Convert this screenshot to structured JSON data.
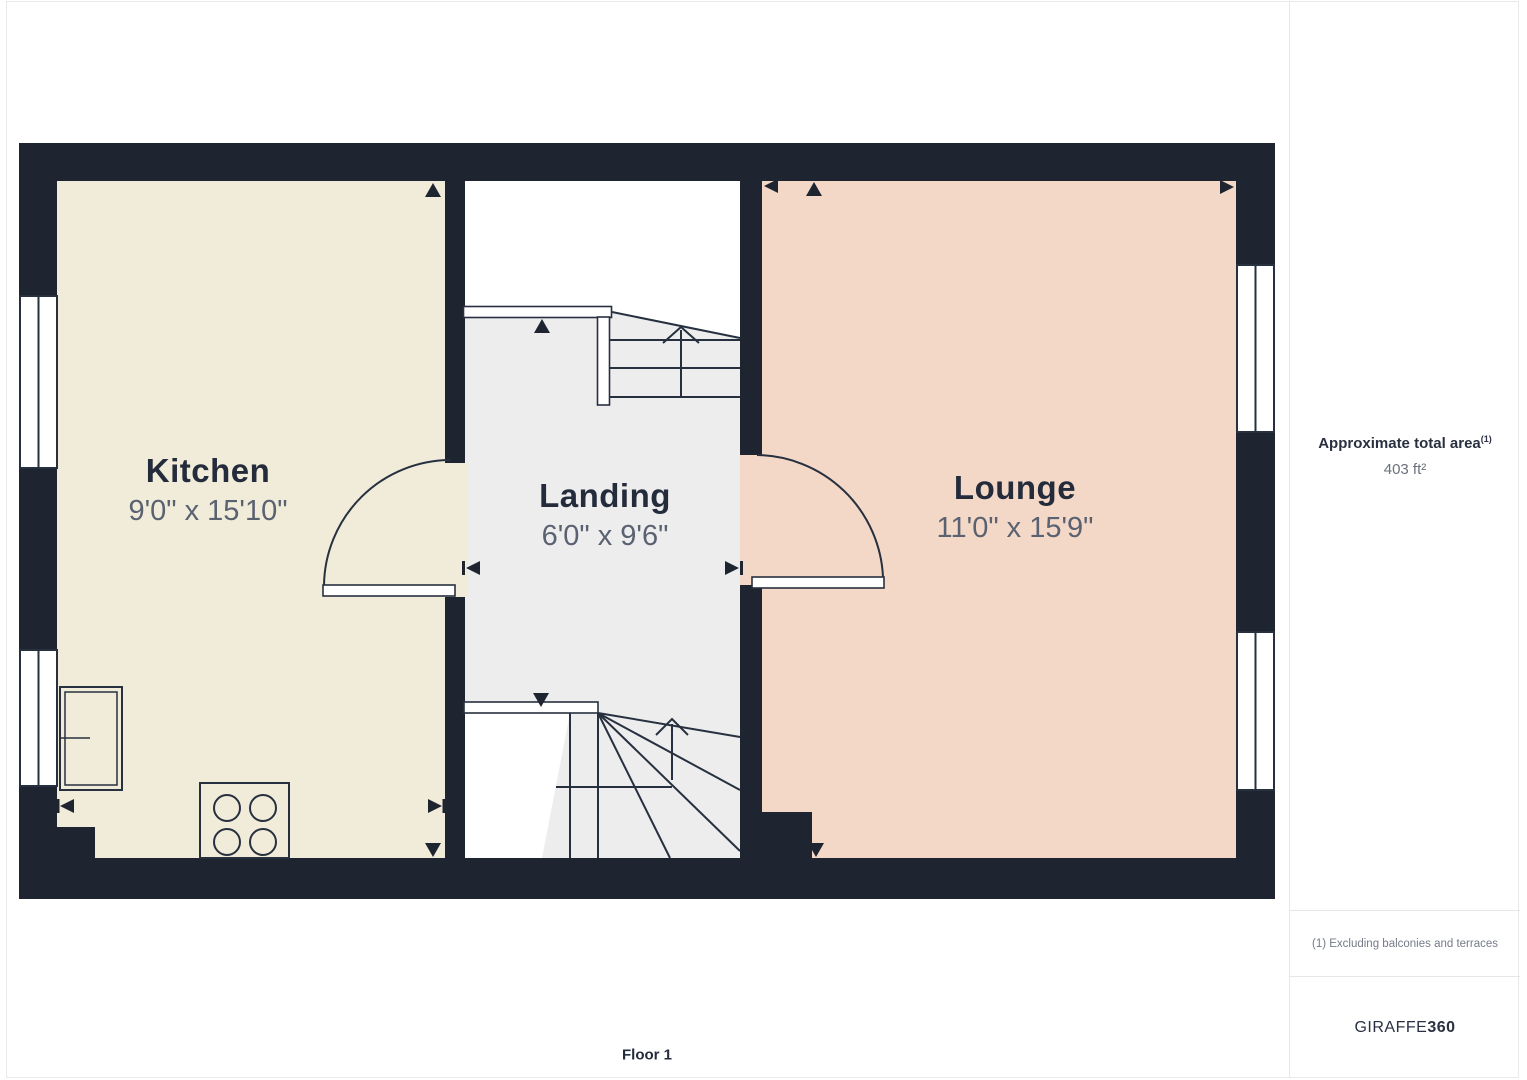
{
  "rooms": [
    {
      "name": "Kitchen",
      "dims": "9'0\" x 15'10\""
    },
    {
      "name": "Landing",
      "dims": "6'0\" x 9'6\""
    },
    {
      "name": "Lounge",
      "dims": "11'0\" x 15'9\""
    }
  ],
  "floor_label": "Floor 1",
  "sidebar": {
    "area_title": "Approximate total area",
    "area_ref": "(1)",
    "area_value": "403 ft²",
    "footnote": "(1) Excluding balconies and terraces",
    "brand_regular": "GIRAFFE",
    "brand_bold": "360"
  },
  "colors": {
    "wall": "#1e2531",
    "kitchen_fill": "#f1ecd9",
    "landing_fill": "#ededee",
    "lounge_fill": "#f4d8c7",
    "label_primary": "#242c3c",
    "label_secondary": "#5a6170",
    "border": "#e9e9e9"
  }
}
